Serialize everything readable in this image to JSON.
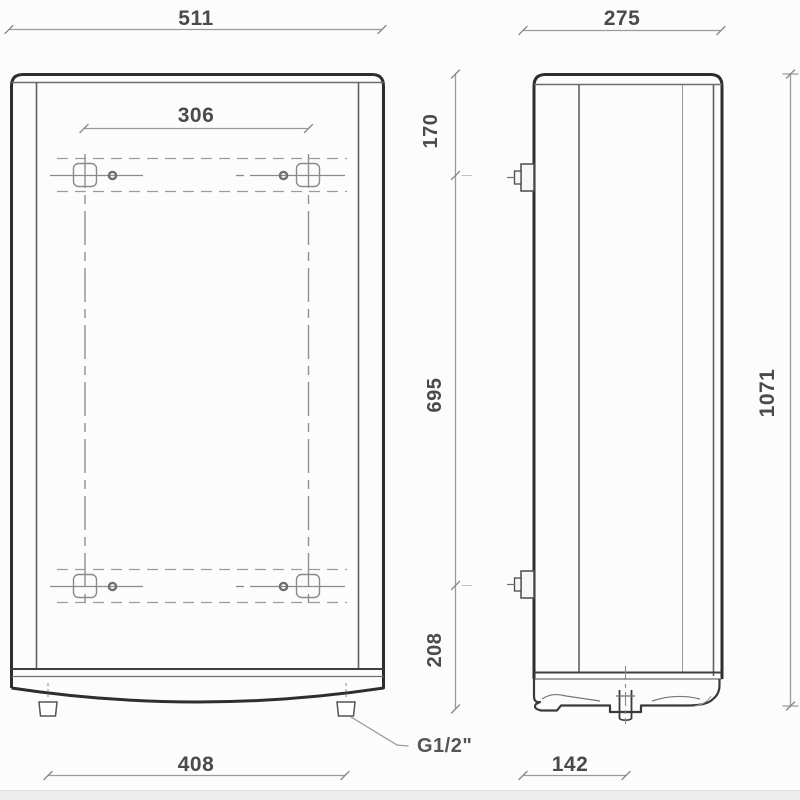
{
  "drawing": {
    "type": "technical-dimension-drawing",
    "views": [
      "front",
      "side"
    ],
    "front_view": {
      "dim_width_top": "511",
      "dim_bracket_hole_spacing": "306",
      "dim_feet_spacing_bottom": "408",
      "pipe_connection_label": "G1/2\""
    },
    "side_view": {
      "dim_depth_top": "275",
      "dim_pipe_offset_bottom": "142",
      "dim_total_height": "1071",
      "dim_top_to_upper_bracket": "170",
      "dim_bracket_spacing": "695",
      "dim_lower_bracket_to_bottom": "208"
    },
    "colors": {
      "outline": "#2e2e2e",
      "inner_line": "#6e6e6e",
      "hidden_line": "#8f8f8f",
      "dimension_line": "#9a9a9a",
      "text": "#4a4a4a",
      "background": "#fcfcfc"
    }
  }
}
